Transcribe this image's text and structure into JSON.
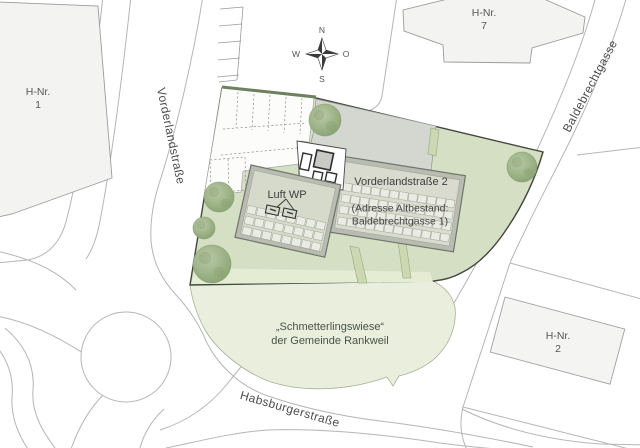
{
  "labels": {
    "hnr1": {
      "l1": "H-Nr.",
      "l2": "1"
    },
    "hnr7": {
      "l1": "H-Nr.",
      "l2": "7"
    },
    "hnr2": {
      "l1": "H-Nr.",
      "l2": "2"
    },
    "luft_wp": "Luft WP",
    "main_building": {
      "title": "Vorderlandstraße 2",
      "sub1": "(Adresse Altbestand:",
      "sub2": "Baldebrechtgasse 1)"
    },
    "meadow": {
      "l1": "„Schmetterlingswiese“",
      "l2": "der Gemeinde Rankweil"
    },
    "streets": {
      "vorderlandstrasse": "Vorderlandstraße",
      "baldebrechtgasse": "Baldebrechtgasse",
      "habsburgerstrasse": "Habsburgerstraße"
    },
    "compass": {
      "n": "N",
      "o": "O",
      "s": "S",
      "w": "W"
    }
  },
  "colors": {
    "site_green": "#d4dfc4",
    "site_border": "#41473f",
    "meadow_green": "#e9efdc",
    "lawn_strip_green": "#cbd8b1",
    "roof_band_gray": "#b8bcb1",
    "roof_inner_gray": "#d8dbce",
    "panel_fill": "#eaece4",
    "neighbor_building_fill": "#f3f3f2",
    "street_line": "#b5b5b5",
    "hedge_green": "#6d8160",
    "tree_green": "#8ba475"
  }
}
